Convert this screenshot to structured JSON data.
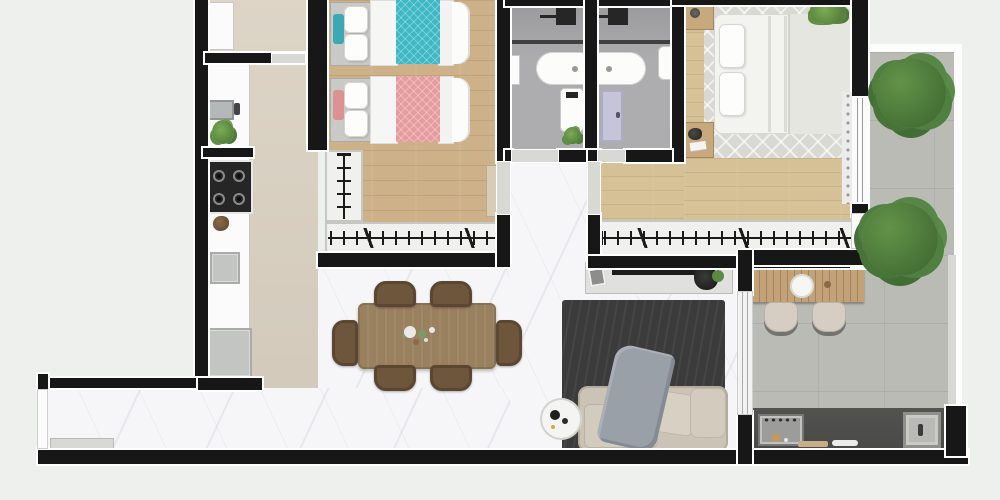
{
  "meta": {
    "view": "top-down-3d-render",
    "subject": "apartment-floor-plan",
    "canvas_width": 1000,
    "canvas_height": 500
  },
  "palette": {
    "bg": "#eef0ee",
    "wall": "#171717",
    "outline": "#ffffff",
    "marble": "#f6f6f8",
    "beige": "#dbd2c3",
    "wood": "#cdb189",
    "woodm": "#d6c096",
    "concrete": "#b9bbb4",
    "bathfloor": "#a8a8aa",
    "rugdark": "#3b3b3b",
    "ruglight": "#d9d9d4",
    "sofa": "#cbc4b6",
    "throw": "#9aa0a8",
    "teal": "#3eb8c4",
    "pink": "#e59c9e",
    "dwood": "#99805f",
    "chair": "#6e563c",
    "barwood": "#c3a277",
    "nstand": "#c8a97e",
    "closet": "#f0f0ee",
    "white": "#fbfbfb",
    "appl": "#c3c5c2",
    "cdark": "#494947",
    "lav": "#c6c4d9",
    "tree": "#4e7c3e",
    "plant": "#6fa04b"
  },
  "rooms": [
    {
      "name": "kitchen",
      "floor": "beige",
      "features": [
        "upper-cabinet",
        "sink-counter",
        "faucet",
        "cooktop-4-burners",
        "counter-decor",
        "oven",
        "refrigerator",
        "plant"
      ]
    },
    {
      "name": "service-area",
      "floor": "beige",
      "features": [
        "tall-cabinet",
        "divider-wall",
        "doorway"
      ]
    },
    {
      "name": "bedroom-2",
      "floor": "wood",
      "features": [
        "single-bed-teal",
        "single-bed-pink",
        "l-shaped-wardrobe-with-hangers",
        "door"
      ]
    },
    {
      "name": "bathroom-1",
      "floor": "gray-tile",
      "features": [
        "ceiling-shower",
        "glass-partition",
        "vanity-basin",
        "toilet",
        "plant",
        "shelf",
        "doorway"
      ]
    },
    {
      "name": "bathroom-2",
      "floor": "gray-tile",
      "features": [
        "ceiling-shower",
        "glass-partition",
        "vanity-basin",
        "toilet",
        "lavender-door",
        "doorway"
      ]
    },
    {
      "name": "master-bedroom",
      "floor": "wood",
      "features": [
        "double-bed",
        "chevron-area-rug",
        "nightstand-left-top",
        "nightstand-left-bottom",
        "plant",
        "curtain",
        "window",
        "wardrobe-with-hangers",
        "garden-door"
      ]
    },
    {
      "name": "dining-area",
      "floor": "marble",
      "features": [
        "wood-table",
        "6-chairs",
        "centerpiece"
      ]
    },
    {
      "name": "living-room",
      "floor": "marble",
      "features": [
        "tv-console",
        "tv",
        "picture-frame",
        "decor",
        "dark-rug",
        "sofa",
        "throw-blanket",
        "cushions",
        "round-side-table",
        "sliding-door"
      ]
    },
    {
      "name": "entry-hall",
      "floor": "marble",
      "features": [
        "entry-door",
        "low-bench"
      ]
    },
    {
      "name": "barbecue-terrace",
      "floor": "concrete",
      "features": [
        "slatted-bar-table",
        "round-basin",
        "2-stools",
        "dark-counter",
        "grill",
        "sink",
        "cutting-board"
      ]
    },
    {
      "name": "side-garden",
      "floor": "concrete",
      "features": [
        "tree",
        "tree"
      ]
    }
  ],
  "counts": {
    "single_beds": 2,
    "double_beds": 1,
    "bathrooms": 2,
    "dining_chairs": 6,
    "bar_stools": 2,
    "trees": 2,
    "wardrobes": 3,
    "showers": 2,
    "toilets": 2
  }
}
